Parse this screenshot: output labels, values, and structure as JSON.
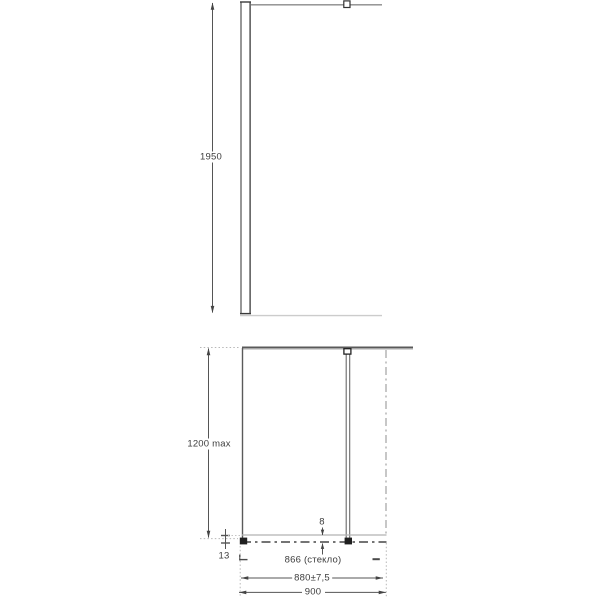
{
  "drawing": {
    "type": "shower-panel-dimension-drawing",
    "front_view": {
      "dim_height": "1950"
    },
    "plan_view": {
      "dim_depth_max": "1200 max",
      "dim_wall_offset": "13",
      "dim_glass_thickness": "8",
      "dim_glass_width": "866 (стекло)",
      "dim_adjustment": "880±7,5",
      "dim_total_width": "900"
    },
    "colors": {
      "line_dark": "#4a4a4a",
      "line_medium": "#8a8a8a",
      "line_light": "#c9c9c9",
      "fill_connector": "#1f1f1f",
      "text": "#3d3d3d",
      "background": "#ffffff"
    }
  }
}
